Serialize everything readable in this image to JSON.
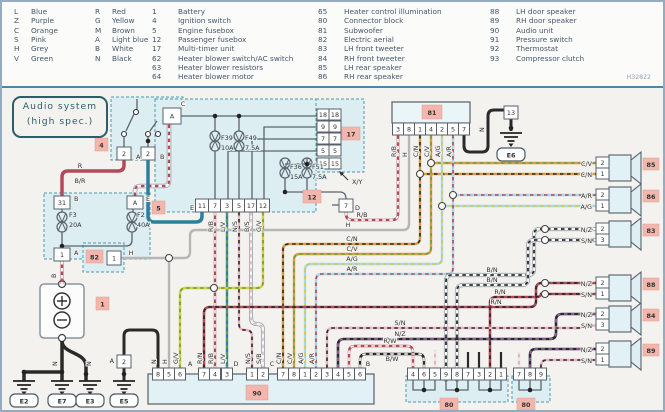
{
  "legend": {
    "color_codes": [
      {
        "code": "L",
        "name": "Blue"
      },
      {
        "code": "Z",
        "name": "Purple"
      },
      {
        "code": "C",
        "name": "Orange"
      },
      {
        "code": "S",
        "name": "Pink"
      },
      {
        "code": "H",
        "name": "Grey"
      },
      {
        "code": "V",
        "name": "Green"
      },
      {
        "code": "R",
        "name": "Red"
      },
      {
        "code": "G",
        "name": "Yellow"
      },
      {
        "code": "M",
        "name": "Brown"
      },
      {
        "code": "A",
        "name": "Light blue"
      },
      {
        "code": "B",
        "name": "White"
      },
      {
        "code": "N",
        "name": "Black"
      }
    ],
    "components": [
      {
        "num": "1",
        "name": "Battery"
      },
      {
        "num": "4",
        "name": "Ignition switch"
      },
      {
        "num": "5",
        "name": "Engine fusebox"
      },
      {
        "num": "12",
        "name": "Passenger fusebox"
      },
      {
        "num": "17",
        "name": "Multi-timer unit"
      },
      {
        "num": "62",
        "name": "Heater blower switch/AC switch"
      },
      {
        "num": "63",
        "name": "Heater blower resistors"
      },
      {
        "num": "64",
        "name": "Heater blower motor"
      },
      {
        "num": "65",
        "name": "Heater control illumination"
      },
      {
        "num": "80",
        "name": "Connector block"
      },
      {
        "num": "81",
        "name": "Subwoofer"
      },
      {
        "num": "82",
        "name": "Electric aerial"
      },
      {
        "num": "83",
        "name": "LH front tweeter"
      },
      {
        "num": "84",
        "name": "RH front tweeter"
      },
      {
        "num": "85",
        "name": "LH rear speaker"
      },
      {
        "num": "86",
        "name": "RH rear speaker"
      },
      {
        "num": "88",
        "name": "LH door speaker"
      },
      {
        "num": "89",
        "name": "RH door speaker"
      },
      {
        "num": "90",
        "name": "Audio unit"
      },
      {
        "num": "91",
        "name": "Pressure switch"
      },
      {
        "num": "92",
        "name": "Thermostat"
      },
      {
        "num": "93",
        "name": "Compressor clutch"
      }
    ],
    "ref": "H32822"
  },
  "title": {
    "line1": "Audio system",
    "line2": "(high spec.)"
  },
  "colors": {
    "L": "#2e7f9e",
    "Z": "#9a5fa5",
    "C": "#d79a45",
    "S": "#e9b4c2",
    "H": "#b6b6b6",
    "V": "#66a23c",
    "R": "#b34a5a",
    "G": "#d6ce3e",
    "M": "#8b5a33",
    "A": "#aad6e6",
    "B": "#f8f8f8",
    "N": "#2a2a2a",
    "W": "#ffffff"
  },
  "wire_labels": [
    "R",
    "B/R",
    "B",
    "L",
    "R/B",
    "H",
    "C/N",
    "C/V",
    "A/G",
    "A/R",
    "H",
    "X/Y",
    "R/B",
    "L/V",
    "N/S",
    "B/S",
    "G/V",
    "R/B",
    "H",
    "C/N",
    "C/V",
    "A/G",
    "A/R",
    "N",
    "N",
    "H",
    "G/V",
    "R/N",
    "R/B",
    "L/V",
    "N/S",
    "S/B",
    "C/N",
    "C/V",
    "A/G",
    "A/R",
    "N",
    "N",
    "C/V",
    "C/N",
    "A/R",
    "A/G",
    "N/Z",
    "S/N",
    "N/Z",
    "S/N",
    "N/Z",
    "S/N",
    "N/Z",
    "S/N",
    "B/N",
    "B/N",
    "R/N",
    "R/N",
    "S/N",
    "N/Z",
    "R/W",
    "B/W"
  ],
  "connector_letters": [
    "A",
    "B",
    "B",
    "E",
    "A",
    "C",
    "E",
    "D",
    "A",
    "A",
    "D",
    "C",
    "B"
  ],
  "fuse_labels": [
    "F3",
    "20A",
    "F2",
    "40A",
    "F39",
    "10A",
    "F49",
    "7.5A",
    "F36",
    "15A",
    "F51",
    "7.5A"
  ],
  "pins": {
    "comp4": [
      "2",
      "2"
    ],
    "fb5": [
      "31",
      "A",
      "1"
    ],
    "fb12": [
      "A",
      "11",
      "7",
      "3",
      "5",
      "17",
      "12",
      "7"
    ],
    "t17": [
      "18",
      "18",
      "9",
      "9",
      "7",
      "7",
      "5",
      "5",
      "15",
      "15"
    ],
    "u81": [
      "3",
      "8",
      "1",
      "4",
      "2",
      "5",
      "7"
    ],
    "p13": [
      "13"
    ],
    "u90": [
      "8",
      "5",
      "6",
      "7",
      "4",
      "3",
      "1",
      "2",
      "7",
      "8",
      "1",
      "2",
      "3",
      "4",
      "5",
      "6"
    ],
    "c80a": [
      "4",
      "6",
      "5",
      "9",
      "8",
      "7",
      "3",
      "2",
      "1"
    ],
    "c80b": [
      "7",
      "8",
      "9"
    ],
    "u82": [
      "1"
    ],
    "e5": [
      "2"
    ],
    "spk": [
      "2",
      "1",
      "2",
      "1",
      "2",
      "3",
      "2",
      "1",
      "2",
      "3",
      "2",
      "1"
    ]
  },
  "badges": [
    "4",
    "5",
    "12",
    "17",
    "1",
    "82",
    "81",
    "90",
    "80",
    "80",
    "85",
    "86",
    "83",
    "88",
    "84",
    "89"
  ],
  "grounds": [
    "E2",
    "E7",
    "E3",
    "E5",
    "E6"
  ]
}
